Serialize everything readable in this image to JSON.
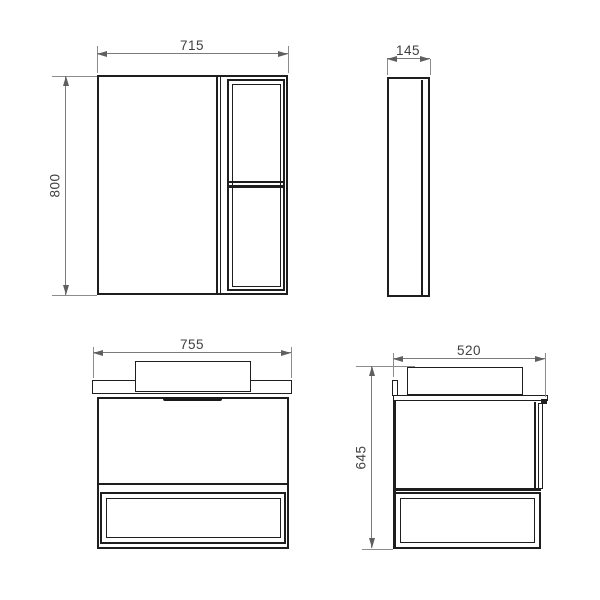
{
  "views": {
    "mirror_cabinet_front": {
      "width_label": "715",
      "height_label": "800"
    },
    "mirror_cabinet_side": {
      "depth_label": "145"
    },
    "vanity_front": {
      "width_label": "755"
    },
    "vanity_side": {
      "depth_label": "520",
      "height_label": "645"
    }
  },
  "colors": {
    "outline": "#1e1e1e",
    "dimension_line": "#7a7a7a",
    "label_text": "#414141",
    "background": "#ffffff"
  }
}
